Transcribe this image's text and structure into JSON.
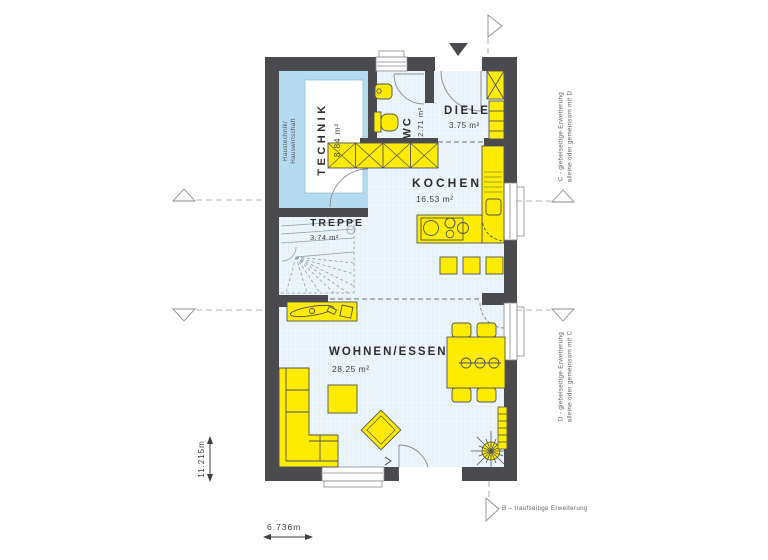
{
  "rooms": {
    "technik": {
      "name": "TECHNIK",
      "area": "8.84 m²",
      "sublabel_line1": "Haustechnik/",
      "sublabel_line2": "Hauswirtschaft"
    },
    "wc": {
      "name": "WC",
      "area": "2.71 m²"
    },
    "diele": {
      "name": "DIELE",
      "area": "3.75 m²"
    },
    "kochen": {
      "name": "KOCHEN",
      "area": "16.53 m²"
    },
    "treppe": {
      "name": "TREPPE",
      "area": "3.74 m²"
    },
    "wohnen_essen": {
      "name": "WOHNEN/ESSEN",
      "area": "28.25 m²"
    }
  },
  "dimensions": {
    "height_label": "11.215m",
    "width_label": "6.736m"
  },
  "annotations": {
    "c_expansion_line1": "C - giebelseitige Erweiterung",
    "c_expansion_line2": "alleine oder gemeinsam mit D",
    "d_expansion_line1": "D - giebelseitige Erweiterung",
    "d_expansion_line2": "alleine oder gemeinsam mit C",
    "b_expansion": "B – traufseitige Erweiterung"
  },
  "colors": {
    "wall": "#4b4b4f",
    "furniture": "#fdec00",
    "technik_fill": "#b5dbf0",
    "floor_fill": "#ecf5fb",
    "outline": "#51525a"
  }
}
